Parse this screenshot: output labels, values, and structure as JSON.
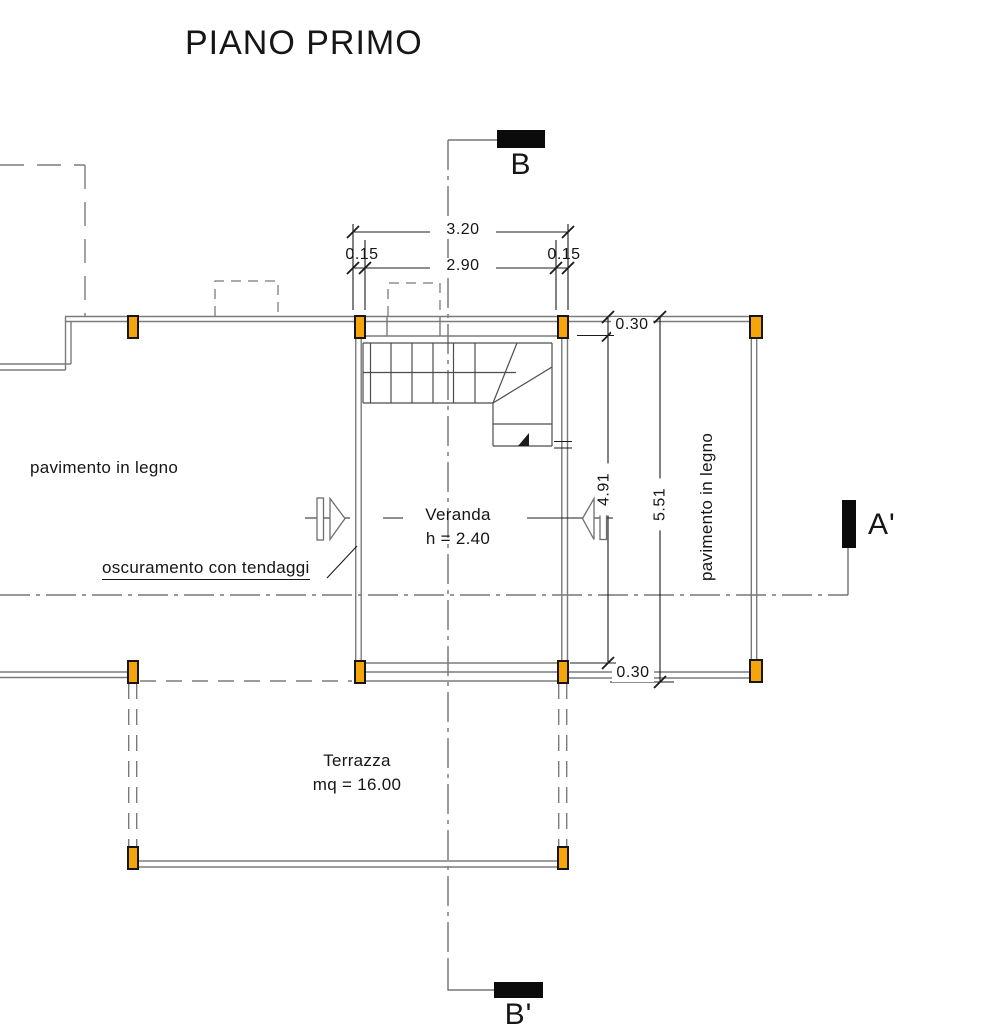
{
  "title": "PIANO PRIMO",
  "sections": {
    "b": "B",
    "b_prime": "B'",
    "a_prime": "A'"
  },
  "dims": {
    "total_width": "3.20",
    "offset_left": "0.15",
    "inner_width": "2.90",
    "offset_right": "0.15",
    "wall_top": "0.30",
    "inner_height": "4.91",
    "total_height": "5.51",
    "wall_bottom": "0.30"
  },
  "labels": {
    "floor_left": "pavimento in legno",
    "floor_right": "pavimento in legno",
    "shading": "oscuramento con tendaggi",
    "room": "Veranda",
    "room_height": "h = 2.40",
    "terrace": "Terrazza",
    "terrace_area": "mq = 16.00"
  },
  "colors": {
    "column": "#F5A50A",
    "ink": "#1c1c1c",
    "wall": "#7b7b7b",
    "cline": "#5a5a5a",
    "stair": "#4d4d4d",
    "marker": "#0b0b0b"
  }
}
